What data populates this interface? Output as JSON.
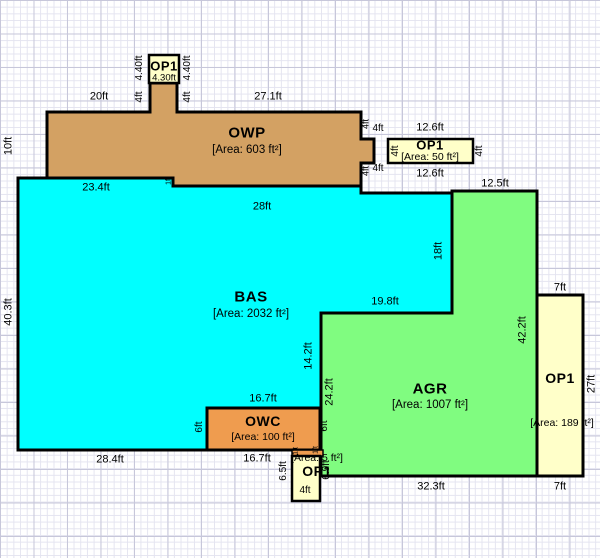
{
  "regions": {
    "owp": {
      "label": "OWP",
      "area": "[Area: 603 ft²]"
    },
    "bas": {
      "label": "BAS",
      "area": "[Area: 2032 ft²]"
    },
    "agr": {
      "label": "AGR",
      "area": "[Area: 1007 ft²]"
    },
    "owc": {
      "label": "OWC",
      "area": "[Area: 100 ft²]"
    },
    "op1_top": {
      "label": "OP1",
      "width": "4.30ft"
    },
    "op1_ne": {
      "label": "OP1",
      "area": "[Area: 50 ft²]"
    },
    "op1_east": {
      "label": "OP1",
      "area": "[Area: 189 ft²]"
    },
    "op1_south": {
      "label": "OP1",
      "area": "[Area: 5 ft²]"
    }
  },
  "dims": {
    "owp_top_left": "20ft",
    "owp_top_right": "27.1ft",
    "owp_left": "10ft",
    "op1_top_side_left": "4.40ft",
    "op1_top_side_right": "4.40ft",
    "stem_left": "4ft",
    "stem_right": "4ft",
    "step": "1ft",
    "bas_left": "40.3ft",
    "bas_top_left": "23.4ft",
    "bas_top_mid": "28ft",
    "arm_top_v": "4ft",
    "arm_top_h": "4ft",
    "arm_bot_v": "4ft",
    "arm_bot_h": "4ft",
    "op1_ne_left": "4ft",
    "op1_ne_right": "4ft",
    "op1_ne_top": "12.6ft",
    "op1_ne_bottom": "12.6ft",
    "agr_top": "12.5ft",
    "bas_right": "18ft",
    "agr_step_top": "19.8ft",
    "bas_inner_right": "14.2ft",
    "agr_left": "24.2ft",
    "agr_right": "42.2ft",
    "op1_east_top": "7ft",
    "op1_east_right": "27ft",
    "op1_east_bottom": "7ft",
    "agr_bottom": "32.3ft",
    "owc_top": "16.7ft",
    "owc_bottom": "16.7ft",
    "owc_left": "6ft",
    "owc_right": "6ft",
    "bas_bottom": "28.4ft",
    "op1_south_left": "6.5ft",
    "op1_south_right": "6.9ft",
    "op1_south_bottom": "4ft",
    "sliver_left": "1ft",
    "sliver_right": "1ft"
  },
  "colors": {
    "owp": "#D3A163",
    "owc": "#EF9C4F",
    "bas": "#00FFFF",
    "agr": "#80FC80",
    "op": "#FFFFC9",
    "outline": "#000000"
  }
}
